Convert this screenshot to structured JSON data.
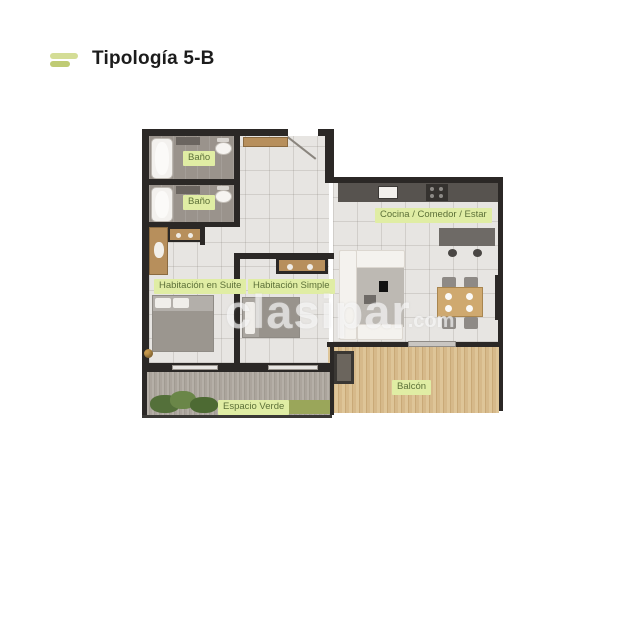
{
  "header": {
    "title": "Tipología 5-B"
  },
  "watermark": {
    "brand": "clasipar",
    "tld": ".com"
  },
  "plan": {
    "rooms": [
      {
        "id": "bano-1",
        "label": "Baño"
      },
      {
        "id": "bano-2",
        "label": "Baño"
      },
      {
        "id": "suite",
        "label": "Habitación en Suite"
      },
      {
        "id": "simple",
        "label": "Habitación Simple"
      },
      {
        "id": "cocina",
        "label": "Cocina / Comedor / Estar"
      },
      {
        "id": "balcon",
        "label": "Balcón"
      },
      {
        "id": "verde",
        "label": "Espacio Verde"
      }
    ]
  },
  "colors": {
    "accent_bar_light": "#d4dd96",
    "accent_bar_dark": "#bfcb74",
    "label_bg": "#e0eda4",
    "label_text": "#5c7038",
    "wall": "#2b2826",
    "floor": "#e7e5e2",
    "floor_dark": "#9a938c",
    "counter": "#57534f",
    "title_text": "#1c1c1c",
    "watermark": "rgba(255,255,255,0.60)"
  }
}
